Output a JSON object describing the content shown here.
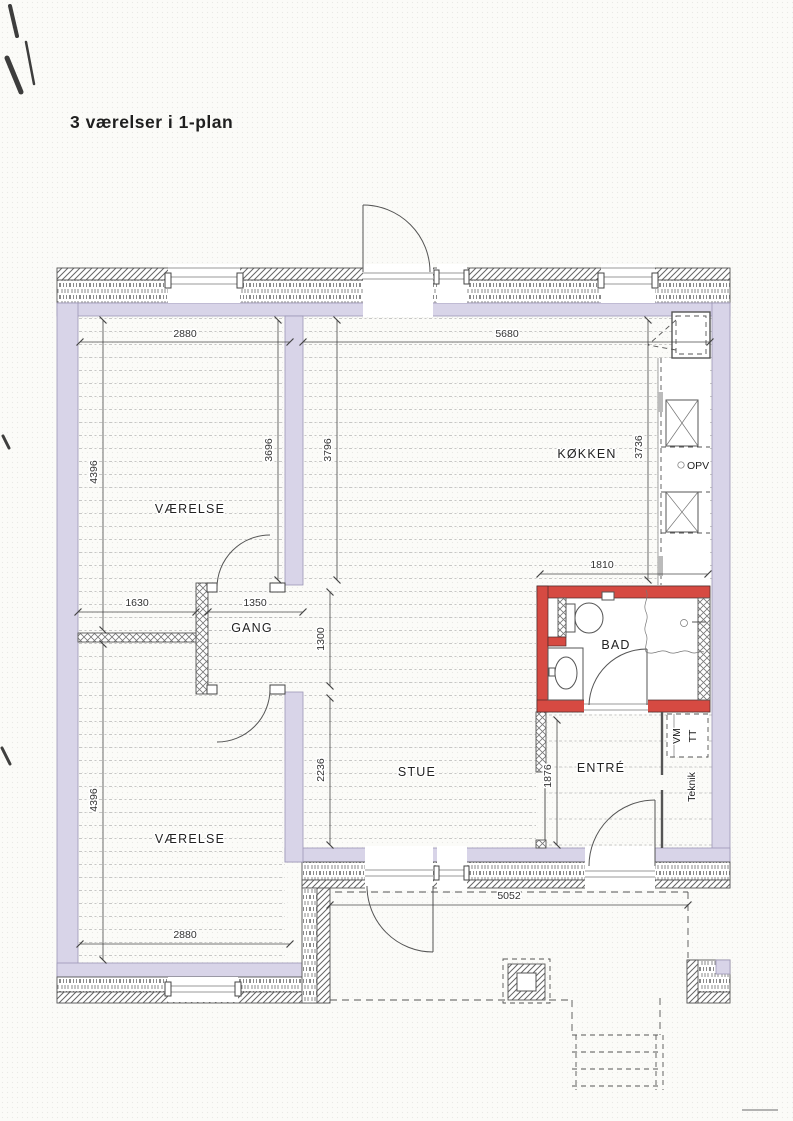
{
  "title": "3 værelser i 1-plan",
  "rooms": {
    "bedroom_top": "VÆRELSE",
    "bedroom_bottom": "VÆRELSE",
    "hall": "GANG",
    "living": "STUE",
    "kitchen": "KØKKEN",
    "bath": "BAD",
    "entry": "ENTRÉ",
    "tech": "Teknik"
  },
  "appliances": {
    "dishwasher": "OPV",
    "washing_machine": "VM",
    "tumble_dryer": "TT"
  },
  "dimensions": {
    "bedroom_top_width": "2880",
    "kitchen_living_width": "5680",
    "bedroom_top_height_outer": "4396",
    "bedroom_top_height_inner": "3696",
    "living_upper_height": "3796",
    "kitchen_height": "3736",
    "bath_width": "1810",
    "hall_left_offset": "1630",
    "hall_width": "1350",
    "hall_height": "1300",
    "living_lower_height": "2236",
    "entry_height": "1876",
    "bedroom_bottom_height": "4396",
    "bedroom_bottom_width": "2880",
    "terrace_width": "5052"
  },
  "colors": {
    "wall_fill": "#d8d4e8",
    "bath_wall": "#d64a42",
    "outline": "#555555",
    "floor_line": "#b6b6b6",
    "paper": "#fbfbf8"
  }
}
